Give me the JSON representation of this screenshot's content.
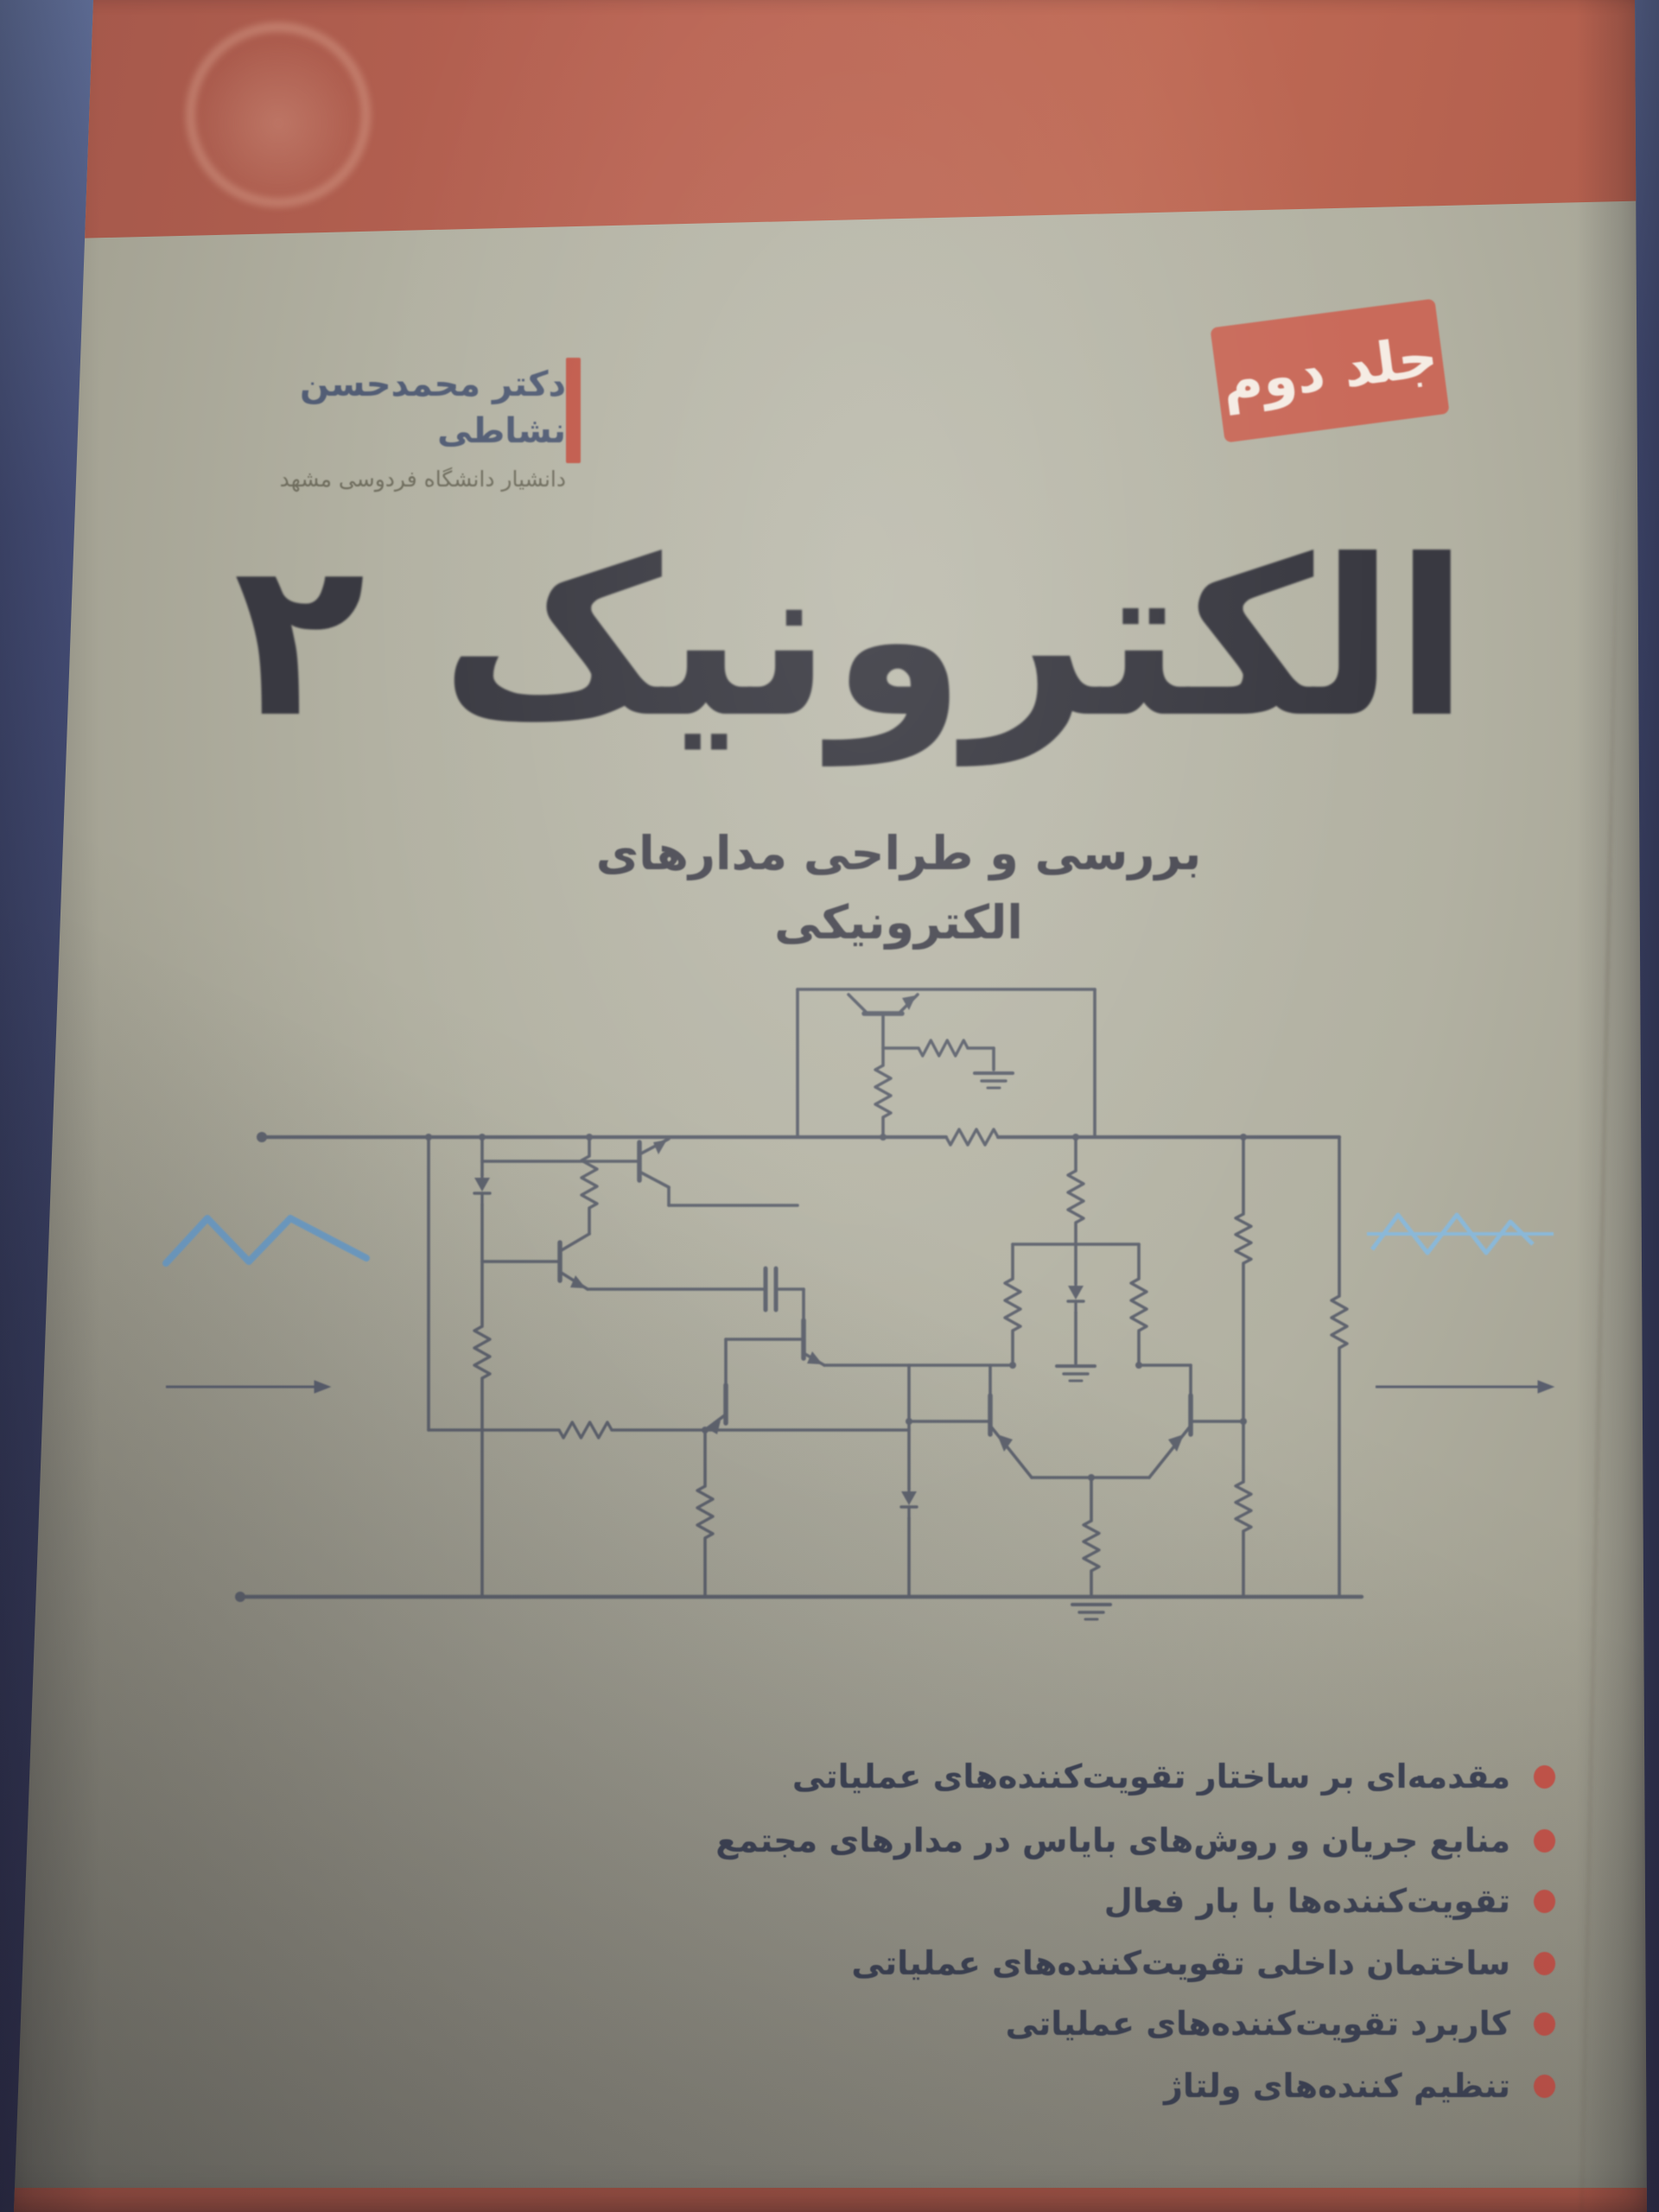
{
  "image_type": "photograph of the front cover of a Persian electronics textbook",
  "background": {
    "surface_color_top": "#5d6b93",
    "surface_color_bottom": "#343453"
  },
  "cover": {
    "top_band_color": "#b96352",
    "body_color": "#adac9d",
    "bottom_band_color": "#b25b4a",
    "watermark": "faint embossed university emblem on red band",
    "author_block": {
      "name": "دکتر محمدحسن نشاطی",
      "affiliation": "دانشیار دانشگاه فردوسی مشهد",
      "accent_bar_color": "#c15a4b"
    },
    "edition_badge": {
      "label": "جلد دوم",
      "background_color": "#c96a5a",
      "text_color": "#f5ece4"
    },
    "title": "الکترونیک ۲",
    "subtitle": "بررسی و طراحی مدارهای الکترونیکی",
    "illustration": {
      "description": "transistor-level operational-amplifier schematic with differential pair, current mirror, resistors, zener diodes and ground symbols; blue triangle input waveform at left and clipped blue output waveform at right with signal-flow arrows",
      "line_color": "#585d6b",
      "input_waveform_color": "#6e9cc3",
      "output_waveform_color": "#8ab8d8"
    },
    "topics": [
      {
        "text": "مقدمه‌ای بر ساختار تقویت‌کننده‌های عملیاتی"
      },
      {
        "text": "منابع جریان و روش‌های بایاس در مدارهای مجتمع"
      },
      {
        "text": "تقویت‌کننده‌ها با بار فعال"
      },
      {
        "text": "ساختمان داخلی تقویت‌کننده‌های عملیاتی"
      },
      {
        "text": "کاربرد تقویت‌کننده‌های عملیاتی"
      },
      {
        "text": "تنظیم کننده‌های ولتاژ"
      }
    ],
    "topic_bullet_color": "#c4544a"
  }
}
